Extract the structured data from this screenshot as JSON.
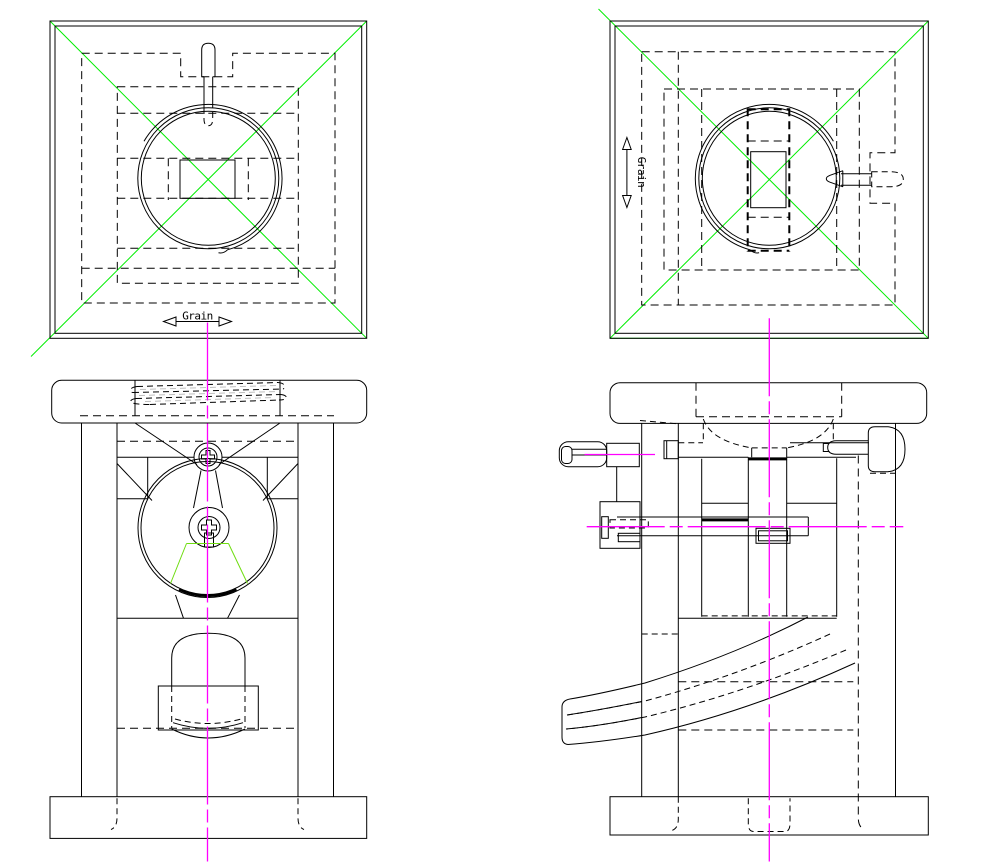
{
  "drawing": {
    "background_color": "#ffffff",
    "line_color": "#000000",
    "colors": {
      "construction": "#00ee00",
      "funnel_highlight": "#6fdd11",
      "centerline": "#ff00ff",
      "phantom": "#bfbfbf"
    },
    "labels": {
      "grain_top": "Grain",
      "grain_side": "Grain"
    }
  }
}
